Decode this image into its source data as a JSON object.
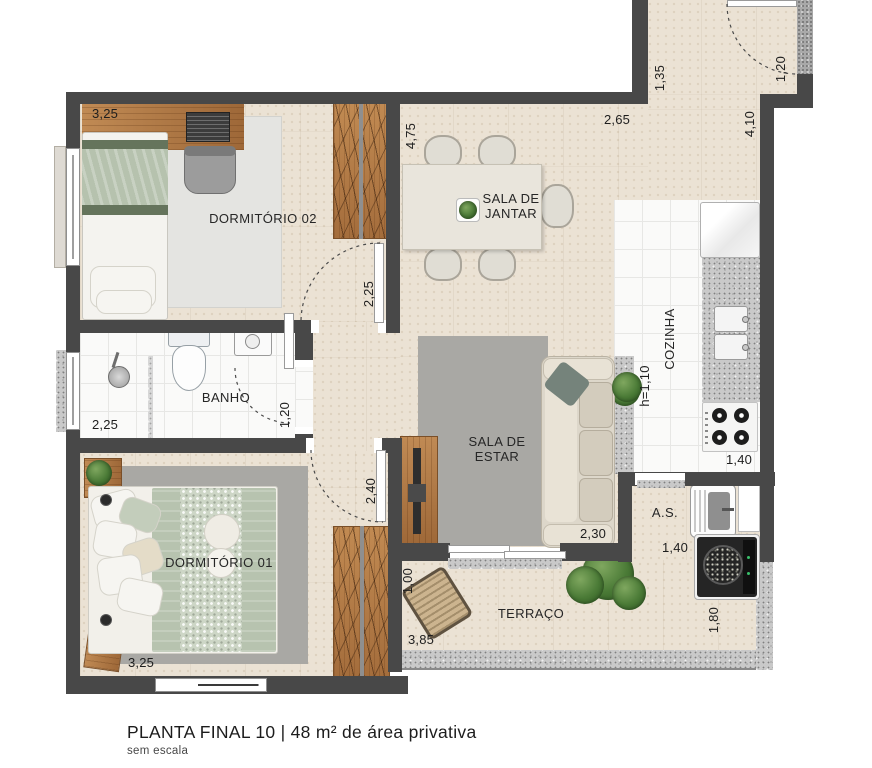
{
  "plan": {
    "title": "PLANTA FINAL 10 | 48 m² de área privativa",
    "scale_note": "sem escala",
    "rooms": {
      "dormitorio02": {
        "label": "DORMITÓRIO 02"
      },
      "sala_jantar": {
        "line1": "SALA DE",
        "line2": "JANTAR"
      },
      "banho": {
        "label": "BANHO"
      },
      "sala_estar": {
        "line1": "SALA DE",
        "line2": "ESTAR"
      },
      "cozinha": {
        "label": "COZINHA"
      },
      "dormitorio01": {
        "label": "DORMITÓRIO 01"
      },
      "terraco": {
        "label": "TERRAÇO"
      },
      "area_servico": {
        "label": "A.S."
      }
    },
    "dimensions": {
      "dorm02_top": "3,25",
      "dorm02_door": "2,25",
      "jantar_left": "4,75",
      "jantar_top": "2,65",
      "entry_width": "1,35",
      "entry_door": "1,20",
      "entry_depth": "4,10",
      "cozinha_counter_height": "h=1,10",
      "cozinha_width": "1,40",
      "banho_width": "2,25",
      "banho_door": "1,20",
      "estar_width": "2,30",
      "dorm01_door": "2,40",
      "dorm01_width": "3,25",
      "terraco_depth": "1,00",
      "terraco_width": "3,85",
      "as_width": "1,40",
      "as_depth": "1,80"
    },
    "icons": {
      "tree_icon": "green-circle-in-white-tile",
      "plant_icon": "green-radial-circle",
      "lamp_icon": "dark-dot",
      "stove_burners": "four-dark-circles",
      "shower_head": "gray-circle"
    },
    "colors": {
      "wall": "#484848",
      "floor_travertine": "#ebe2d4",
      "floor_tile": "#fafaf9",
      "wood": "#b07a48",
      "granite": "#c9c9c9",
      "rug_dark": "#a9a8a4",
      "rug_light": "#e4e4e1",
      "sage_green": "#b6c2ae",
      "plant_green": "#4a7a36",
      "sofa_cream": "#ddd7ca"
    }
  }
}
